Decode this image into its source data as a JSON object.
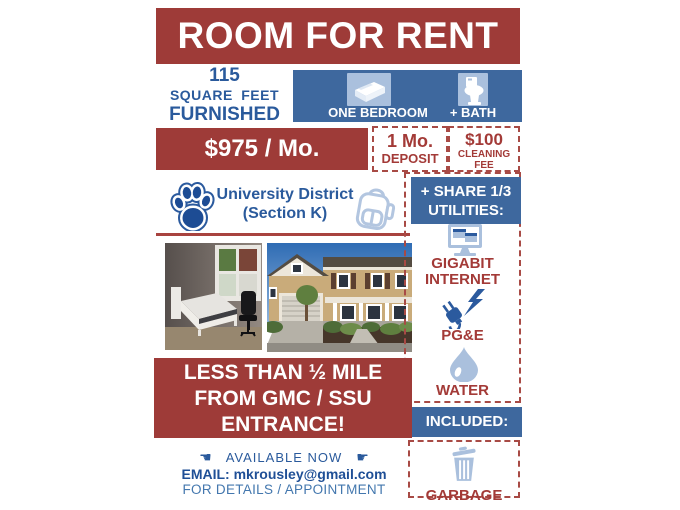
{
  "header": {
    "title": "ROOM FOR RENT"
  },
  "specs": {
    "size_line1": "115",
    "size_line2": "SQUARE FEET",
    "size_line3": "FURNISHED",
    "bedroom_label": "ONE BEDROOM",
    "bath_label": "+ BATH"
  },
  "pricing": {
    "rent": "$975 / Mo.",
    "deposit_line1": "1 Mo.",
    "deposit_line2": "DEPOSIT",
    "cleaning_line1": "$100",
    "cleaning_line2": "CLEANING",
    "cleaning_line3": "FEE"
  },
  "location": {
    "line1": "University District",
    "line2": "(Section K)"
  },
  "utilities": {
    "header_line1": "+ SHARE 1/3",
    "header_line2": "UTILITIES:",
    "items": [
      {
        "icon": "desktop-computer-icon",
        "label": "GIGABIT INTERNET"
      },
      {
        "icon": "power-plug-icon",
        "label": "PG&E"
      },
      {
        "icon": "water-drop-icon",
        "label": "WATER"
      }
    ],
    "included_header": "INCLUDED:",
    "included_item": {
      "icon": "trash-can-icon",
      "label": "GARBAGE"
    }
  },
  "distance": {
    "line1": "LESS THAN ½ MILE",
    "line2": "FROM GMC / SSU",
    "line3": "ENTRANCE!"
  },
  "contact": {
    "hand_left": "☚",
    "availability": "AVAILABLE NOW",
    "hand_right": "☛",
    "email": "EMAIL: mkrousley@gmail.com",
    "details": "FOR DETAILS / APPOINTMENT"
  },
  "photos": {
    "left": "bedroom interior with bed, window and desk chair",
    "right": "two-story house exterior"
  },
  "colors": {
    "red": "#9E3B38",
    "blue": "#3E689E",
    "light_blue": "#AAC0DD",
    "text_blue": "#2A5A9C",
    "text_red": "#A33A37"
  }
}
